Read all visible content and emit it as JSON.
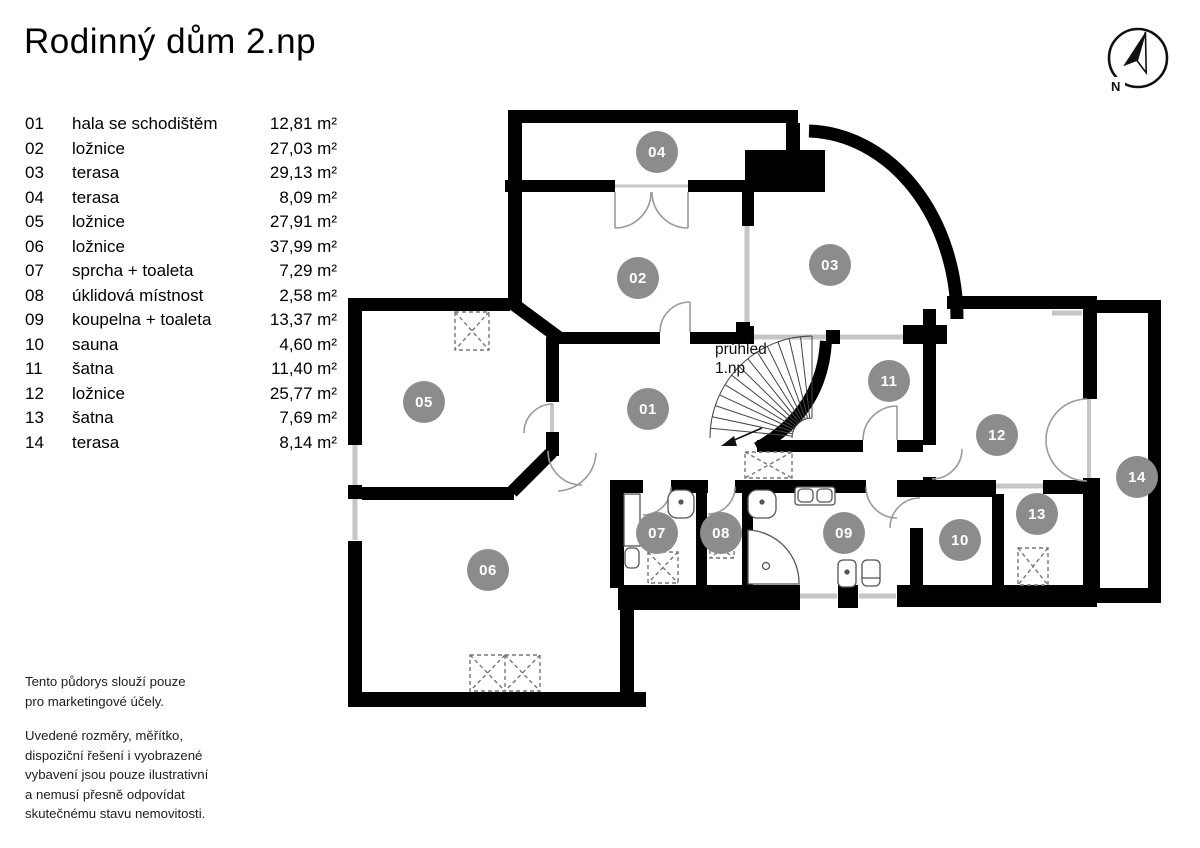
{
  "header": {
    "title": "Rodinný dům 2.np"
  },
  "compass": {
    "north_label": "N"
  },
  "rooms": [
    {
      "id": "01",
      "name": "hala se schodištěm",
      "area": "12,81 m²"
    },
    {
      "id": "02",
      "name": "ložnice",
      "area": "27,03 m²"
    },
    {
      "id": "03",
      "name": "terasa",
      "area": "29,13 m²"
    },
    {
      "id": "04",
      "name": "terasa",
      "area": "8,09 m²"
    },
    {
      "id": "05",
      "name": "ložnice",
      "area": "27,91 m²"
    },
    {
      "id": "06",
      "name": "ložnice",
      "area": "37,99 m²"
    },
    {
      "id": "07",
      "name": "sprcha + toaleta",
      "area": "7,29 m²"
    },
    {
      "id": "08",
      "name": "úklidová místnost",
      "area": "2,58 m²"
    },
    {
      "id": "09",
      "name": "koupelna + toaleta",
      "area": "13,37 m²"
    },
    {
      "id": "10",
      "name": "sauna",
      "area": "4,60 m²"
    },
    {
      "id": "11",
      "name": "šatna",
      "area": "11,40 m²"
    },
    {
      "id": "12",
      "name": "ložnice",
      "area": "25,77 m²"
    },
    {
      "id": "13",
      "name": "šatna",
      "area": "7,69 m²"
    },
    {
      "id": "14",
      "name": "terasa",
      "area": "8,14 m²"
    }
  ],
  "plan": {
    "overlook_label": "průhled\n1.np"
  },
  "footer": {
    "para1": "Tento půdorys slouží pouze\npro marketingové účely.",
    "para2": "Uvedené rozměry, měřítko,\ndispoziční řešení i vyobrazené\nvybavení jsou pouze ilustrativní\na nemusí přesně odpovídat\nskutečnému stavu nemovitosti."
  },
  "colors": {
    "wall": "#000000",
    "badge": "#8c8c8c",
    "window": "#c6c6c6",
    "door_arc": "#9a9a9a"
  }
}
